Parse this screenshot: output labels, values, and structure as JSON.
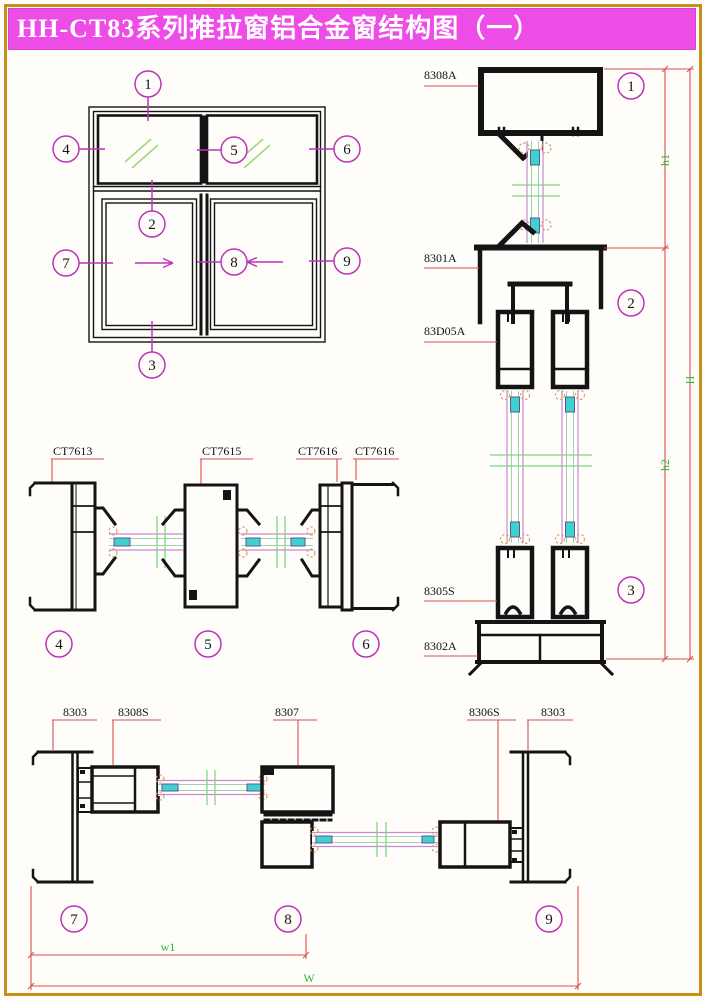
{
  "title": "HH-CT83系列推拉窗铝合金窗结构图（一）",
  "colors": {
    "title_bar": "#ee4ce6",
    "page_border": "#c79018",
    "dim_red": "#d85050",
    "callout_magenta": "#bb33bb",
    "dim_green": "#2db82d",
    "glass_magenta": "#cc88cc",
    "break_green": "#7fd67f",
    "hatch_green": "#9cd97c",
    "spacer_cyan": "#3fd1d1",
    "gasket_orange": "#d9a06a",
    "profile_black": "#141414"
  },
  "elevation": {
    "callouts": [
      "1",
      "2",
      "3",
      "4",
      "5",
      "6",
      "7",
      "8",
      "9"
    ]
  },
  "vertical_section": {
    "labels": [
      "8308A",
      "8301A",
      "83D05A",
      "8305S",
      "8302A"
    ],
    "callouts": [
      "1",
      "2",
      "3"
    ],
    "dims": [
      "h1",
      "h2",
      "H"
    ]
  },
  "horizontal_sections": {
    "labels": [
      "CT7613",
      "CT7615",
      "CT7616",
      "CT7616"
    ],
    "callouts": [
      "4",
      "5",
      "6"
    ]
  },
  "bottom_section": {
    "labels": [
      "8303",
      "8308S",
      "8307",
      "8306S",
      "8303"
    ],
    "callouts": [
      "7",
      "8",
      "9"
    ],
    "dims": [
      "w1",
      "W"
    ]
  }
}
